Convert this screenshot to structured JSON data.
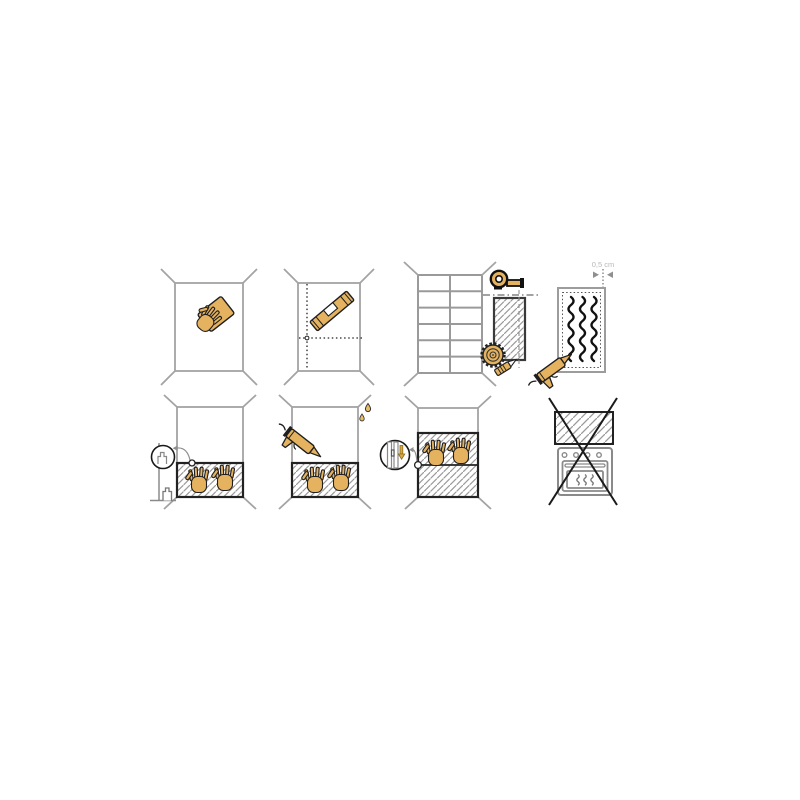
{
  "annotation": {
    "gap_label": "0,5 cm"
  },
  "colors": {
    "background": "#ffffff",
    "tool_fill": "#e5b260",
    "outline": "#1f1f1f",
    "wall_line": "#a3a3a3",
    "panel_border": "#2b2b2b",
    "hatch_line": "#9a9a9a",
    "appliance_line": "#8a8a8a",
    "label_gray": "#b8b8b8",
    "arrow_gray": "#8f8f8f",
    "adhesive_black": "#111111",
    "arrow_yellow": "#dca93e"
  },
  "steps": [
    {
      "index": 1,
      "name": "clean-wall",
      "icons": [
        "wall-surface",
        "sponge-hand-icon"
      ]
    },
    {
      "index": 2,
      "name": "mark-guide-lines",
      "icons": [
        "wall-surface",
        "spirit-level-icon",
        "dotted-guide-lines"
      ]
    },
    {
      "index": 3,
      "name": "measure-and-cut-panel",
      "icons": [
        "tiled-wall",
        "measuring-tape-icon",
        "panel-piece",
        "circular-blade-icon",
        "utility-knife-icon"
      ]
    },
    {
      "index": 4,
      "name": "apply-adhesive",
      "icons": [
        "panel-back",
        "adhesive-beads",
        "caulking-gun-icon"
      ],
      "label": "0,5 cm"
    },
    {
      "index": 5,
      "name": "position-panel-on-spacer",
      "icons": [
        "wall-surface",
        "panel",
        "pressing-hand-icon",
        "spacer-icon",
        "magnifier-detail"
      ]
    },
    {
      "index": 6,
      "name": "seal-top-edge",
      "icons": [
        "wall-surface",
        "panel",
        "pressing-hand-icon",
        "caulking-gun-icon",
        "droplet-icon"
      ]
    },
    {
      "index": 7,
      "name": "join-second-panel",
      "icons": [
        "wall-surface",
        "stacked-panels",
        "pressing-hand-icon",
        "joint-connector-detail",
        "magnifier-detail"
      ]
    },
    {
      "index": 8,
      "name": "do-not-install-above-oven",
      "icons": [
        "panel",
        "oven-icon",
        "prohibition-cross-icon"
      ]
    }
  ]
}
